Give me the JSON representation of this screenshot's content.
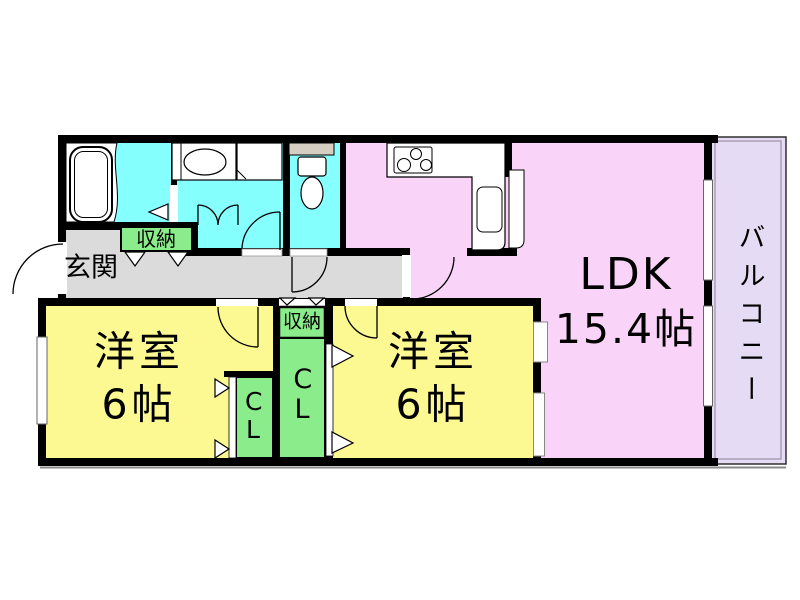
{
  "plan": {
    "rooms": {
      "ldk": {
        "label": "LDK",
        "size": "15.4帖"
      },
      "bedroom_west": {
        "label": "洋室",
        "size": "6帖"
      },
      "bedroom_center": {
        "label": "洋室",
        "size": "6帖"
      },
      "entrance": {
        "label": "玄関"
      },
      "hall_storage": {
        "label": "収納"
      },
      "center_storage": {
        "label": "収納"
      },
      "closet_west": {
        "label": "CL"
      },
      "closet_center": {
        "label": "CL"
      },
      "balcony": {
        "label": "バルコニー"
      }
    },
    "fixtures": [
      "bathtub",
      "vanity-sink",
      "washing-machine-pan",
      "toilet",
      "toilet-shelf",
      "gas-stove",
      "kitchen-sink",
      "kitchen-counter",
      "refrigerator-space"
    ],
    "colors": {
      "ldk": "#F9D3F8",
      "bedroom": "#FCF892",
      "wet_area": "#86FFFF",
      "closet": "#8BEC8B",
      "hallway": "#DBDBDB",
      "balcony": "#E6DBF4",
      "shelf": "#D6CEC0",
      "wall": "#000000",
      "window": "#FFFFFF"
    }
  }
}
